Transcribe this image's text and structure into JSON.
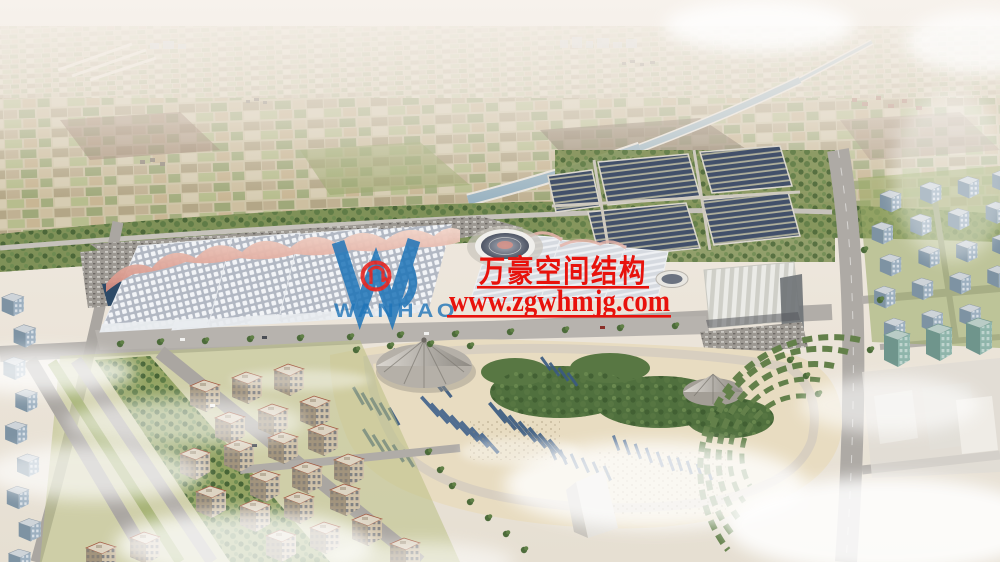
{
  "scene": {
    "type": "aerial-architectural-rendering",
    "subject": "exhibition center campus with wave-roof halls, solar farm, landscaped park, residential districts and farmland horizon"
  },
  "watermark": {
    "company_cn": "万豪空间结构",
    "website": "www.zgwhmjg.com",
    "logo_wordmark": "WANHAO",
    "logo_letter": "W",
    "red": "#e8120c",
    "blue": "#1e74b8"
  },
  "palette": {
    "sky_haze": "#f2ece6",
    "farm_tan": "#cfc5a8",
    "green_belt": "#7f9158",
    "road_gray": "#aaa6a1",
    "plaza_beige": "#e8dcc1",
    "hall_roof": "#b4bac4",
    "hall_ridge_pink": "#d4897c",
    "solar_panel": "#3f4c63",
    "park_bars_blue": "#3b5b81",
    "canal_water": "#a5bcc6",
    "cloud_white": "#ffffff"
  }
}
